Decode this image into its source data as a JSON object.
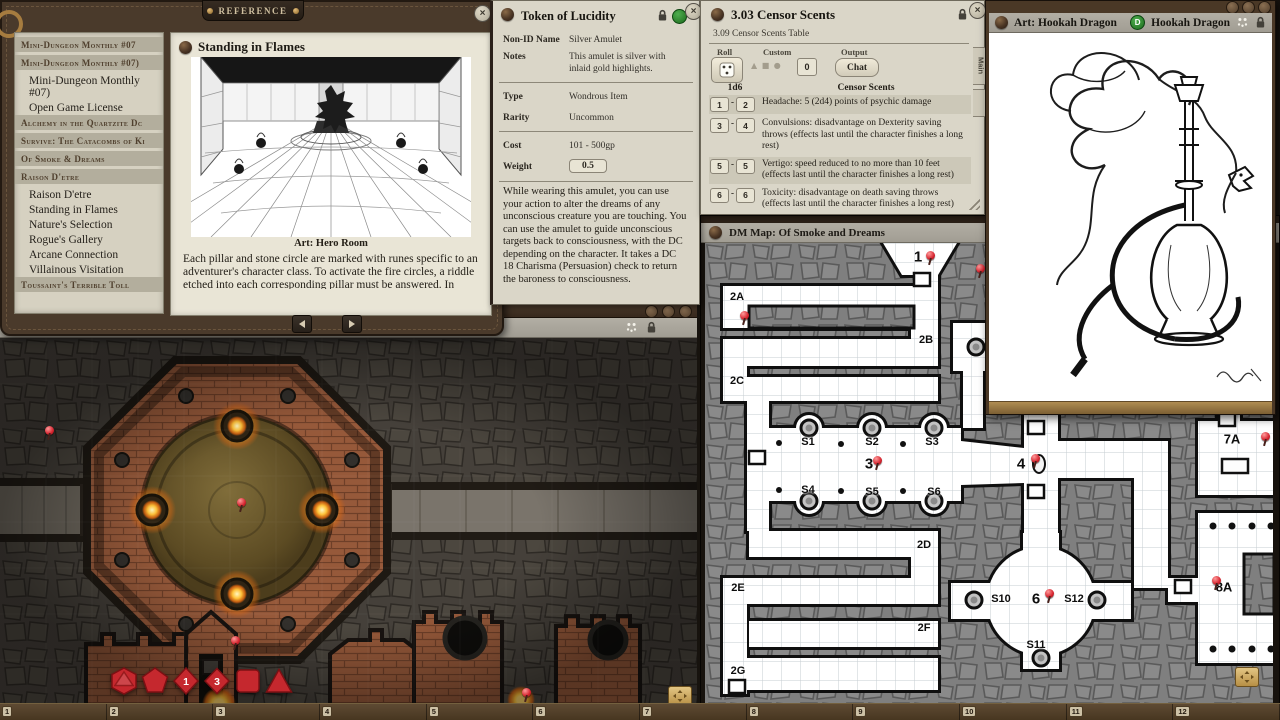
{
  "reference_window": {
    "banner": "REFERENCE",
    "sidebar": {
      "items": [
        {
          "type": "header",
          "label": "Mini-Dungeon Monthly #07"
        },
        {
          "type": "header",
          "label": "Mini-Dungeon Monthly #07)"
        },
        {
          "type": "item",
          "label": "Mini-Dungeon Monthly #07)"
        },
        {
          "type": "item",
          "label": "Open Game License"
        },
        {
          "type": "header",
          "label": "Alchemy in the Quartzite Dc"
        },
        {
          "type": "header",
          "label": "Survive: The Catacombs of Ki"
        },
        {
          "type": "header",
          "label": "Of Smoke & Dreams"
        },
        {
          "type": "header",
          "label": "Raison D'etre"
        },
        {
          "type": "item",
          "label": "Raison D'etre"
        },
        {
          "type": "item",
          "label": "Standing in Flames"
        },
        {
          "type": "item",
          "label": "Nature's Selection"
        },
        {
          "type": "item",
          "label": "Rogue's Gallery"
        },
        {
          "type": "item",
          "label": "Arcane Connection"
        },
        {
          "type": "item",
          "label": "Villainous Visitation"
        },
        {
          "type": "header",
          "label": "Toussaint's Terrible Toll"
        }
      ]
    },
    "page": {
      "title": "Standing in Flames",
      "art_caption": "Art: Hero Room",
      "body": "Each pillar and stone circle are marked with runes specific to an adventurer's character class. To activate the fire circles, a riddle etched into each corresponding pillar must be answered. In order"
    }
  },
  "token_window": {
    "title": "Token of Lucidity",
    "fields": [
      {
        "label": "Non-ID Name",
        "value": "Silver Amulet"
      },
      {
        "label": "Notes",
        "value": "This amulet is silver with inlaid gold highlights."
      },
      {
        "label": "Type",
        "value": "Wondrous Item"
      },
      {
        "label": "Rarity",
        "value": "Uncommon"
      },
      {
        "label": "Cost",
        "value": "101 - 500gp"
      },
      {
        "label": "Weight",
        "value": "0.5"
      }
    ],
    "description": "While wearing this amulet, you can use your action to alter the dreams of any unconscious creature you are touching. You can use the amulet to guide unconscious targets back to consciousness, with the DC depending on the character. It takes a DC 18 Charisma (Persuasion) check to return the baroness to consciousness."
  },
  "censor_window": {
    "title": "3.03 Censor Scents",
    "subtitle": "3.09 Censor Scents Table",
    "controls": {
      "roll_label": "Roll",
      "custom_label": "Custom",
      "custom_value": "0",
      "output_label": "Output",
      "chat_label": "Chat"
    },
    "table": {
      "col1": "1d6",
      "col2": "Censor Scents",
      "range_separator": "-",
      "rows": [
        {
          "from": "1",
          "to": "2",
          "text": "Headache: 5 (2d4) points of psychic damage"
        },
        {
          "from": "3",
          "to": "4",
          "text": "Convulsions: disadvantage on Dexterity saving throws (effects last until the character finishes a long rest)"
        },
        {
          "from": "5",
          "to": "5",
          "text": "Vertigo: speed reduced to no more than 10 feet (effects last until the character finishes a long rest)"
        },
        {
          "from": "6",
          "to": "6",
          "text": "Toxicity: disadvantage on death saving throws (effects last until the character finishes a long rest)"
        }
      ]
    },
    "side_tabs": [
      "Main",
      ""
    ]
  },
  "art_window": {
    "title": "Art: Hookah Dragon",
    "token_badge": "D",
    "token_label": "Hookah Dragon"
  },
  "map_window": {
    "title": "DM Map: Of Smoke and Dreams",
    "labels": [
      {
        "t": "1",
        "x": 213,
        "y": 14,
        "size": "big"
      },
      {
        "t": "2A",
        "x": 32,
        "y": 54
      },
      {
        "t": "2B",
        "x": 221,
        "y": 97
      },
      {
        "t": "2C",
        "x": 32,
        "y": 138
      },
      {
        "t": "S1",
        "x": 103,
        "y": 199
      },
      {
        "t": "S2",
        "x": 167,
        "y": 199
      },
      {
        "t": "S3",
        "x": 227,
        "y": 199
      },
      {
        "t": "3",
        "x": 164,
        "y": 221,
        "size": "big"
      },
      {
        "t": "S4",
        "x": 103,
        "y": 247
      },
      {
        "t": "S5",
        "x": 167,
        "y": 249
      },
      {
        "t": "S6",
        "x": 229,
        "y": 249
      },
      {
        "t": "2D",
        "x": 219,
        "y": 302
      },
      {
        "t": "2E",
        "x": 33,
        "y": 345
      },
      {
        "t": "2F",
        "x": 219,
        "y": 385
      },
      {
        "t": "2G",
        "x": 33,
        "y": 428
      },
      {
        "t": "4",
        "x": 316,
        "y": 221,
        "size": "big"
      },
      {
        "t": "S10",
        "x": 296,
        "y": 356
      },
      {
        "t": "6",
        "x": 331,
        "y": 356,
        "size": "big"
      },
      {
        "t": "S12",
        "x": 369,
        "y": 356
      },
      {
        "t": "S11",
        "x": 331,
        "y": 402
      },
      {
        "t": "7A",
        "x": 527,
        "y": 196,
        "size": "mid"
      },
      {
        "t": "8A",
        "x": 519,
        "y": 344,
        "size": "mid"
      }
    ]
  },
  "battle_window": {
    "dice": [
      {
        "type": "d20",
        "face": ""
      },
      {
        "type": "d12",
        "face": ""
      },
      {
        "type": "d10",
        "face": "1"
      },
      {
        "type": "d8",
        "face": "3"
      },
      {
        "type": "d6",
        "face": ""
      },
      {
        "type": "d4",
        "face": ""
      }
    ]
  },
  "hotbar": {
    "slots": [
      "1",
      "2",
      "3",
      "4",
      "5",
      "6",
      "7",
      "8",
      "9",
      "10",
      "11",
      "12"
    ]
  },
  "colors": {
    "leather_brown": "#4a3a2b",
    "parchment": "#e9e5d6",
    "window_beige": "#dad6c8",
    "titlebar_grey": "#a7a39a",
    "map_stone_grey": "#7f7f7f",
    "brick_orange": "#96593a",
    "dice_red": "#c5282e",
    "pin_red": "#d5232e",
    "id_green": "#1c6b1c"
  }
}
